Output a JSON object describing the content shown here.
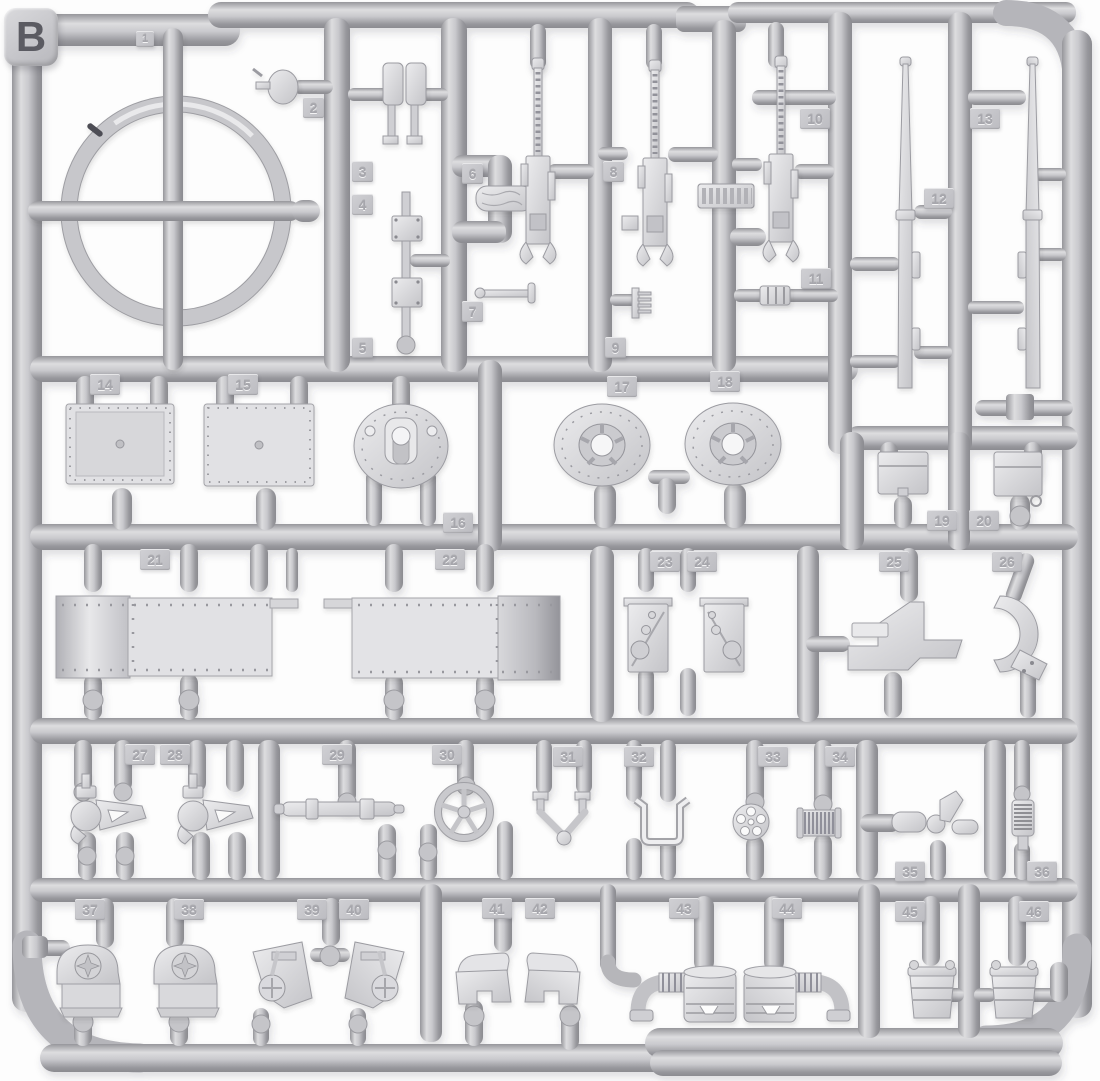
{
  "sprue": {
    "letter": "B",
    "background_color": "#ffffff",
    "plastic_base_color": "#c6c6ca",
    "plastic_highlight_color": "#e4e4e6",
    "plastic_shadow_color": "#8e8e93",
    "tag_text_color": "#a6a6ac"
  },
  "parts": [
    {
      "number": "1",
      "name": "turret-race-ring"
    },
    {
      "number": "2",
      "name": "small-valve-knob"
    },
    {
      "number": "3",
      "name": "periscope-pair"
    },
    {
      "number": "4",
      "name": "mount-block-upper"
    },
    {
      "number": "5",
      "name": "mount-block-lower"
    },
    {
      "number": "6",
      "name": "log-piece"
    },
    {
      "number": "7",
      "name": "charging-handle"
    },
    {
      "number": "8",
      "name": "machine-gun-m2"
    },
    {
      "number": "9",
      "name": "ammo-belt-end"
    },
    {
      "number": "10",
      "name": "machine-gun-m2"
    },
    {
      "number": "11",
      "name": "barrel-collar"
    },
    {
      "number": "12",
      "name": "gun-barrel-long"
    },
    {
      "number": "13",
      "name": "gun-barrel-long"
    },
    {
      "number": "14",
      "name": "hatch-panel"
    },
    {
      "number": "15",
      "name": "hatch-panel"
    },
    {
      "number": "16",
      "name": "dome-mount"
    },
    {
      "number": "17",
      "name": "mg-mount-plate"
    },
    {
      "number": "18",
      "name": "mg-mount-plate"
    },
    {
      "number": "19",
      "name": "stowage-box"
    },
    {
      "number": "20",
      "name": "stowage-box"
    },
    {
      "number": "21",
      "name": "armor-plate-riveted"
    },
    {
      "number": "22",
      "name": "armor-plate-riveted"
    },
    {
      "number": "23",
      "name": "angled-bracket"
    },
    {
      "number": "24",
      "name": "angled-bracket"
    },
    {
      "number": "25",
      "name": "plate-bracket"
    },
    {
      "number": "26",
      "name": "crescent-clamp"
    },
    {
      "number": "27",
      "name": "cradle-bracket"
    },
    {
      "number": "28",
      "name": "cradle-bracket"
    },
    {
      "number": "29",
      "name": "sight-tube"
    },
    {
      "number": "30",
      "name": "handwheel"
    },
    {
      "number": "31",
      "name": "yoke-fork"
    },
    {
      "number": "32",
      "name": "u-bracket"
    },
    {
      "number": "33",
      "name": "spoked-wheel"
    },
    {
      "number": "34",
      "name": "ribbed-drum"
    },
    {
      "number": "35",
      "name": "lever-assembly"
    },
    {
      "number": "36",
      "name": "coil-spring"
    },
    {
      "number": "37",
      "name": "drive-housing"
    },
    {
      "number": "38",
      "name": "drive-housing"
    },
    {
      "number": "39",
      "name": "dial-bracket"
    },
    {
      "number": "40",
      "name": "dial-bracket"
    },
    {
      "number": "41",
      "name": "fender-guard"
    },
    {
      "number": "42",
      "name": "fender-guard"
    },
    {
      "number": "43",
      "name": "air-cleaner"
    },
    {
      "number": "44",
      "name": "air-cleaner"
    },
    {
      "number": "45",
      "name": "fuel-drum"
    },
    {
      "number": "46",
      "name": "fuel-drum"
    }
  ]
}
